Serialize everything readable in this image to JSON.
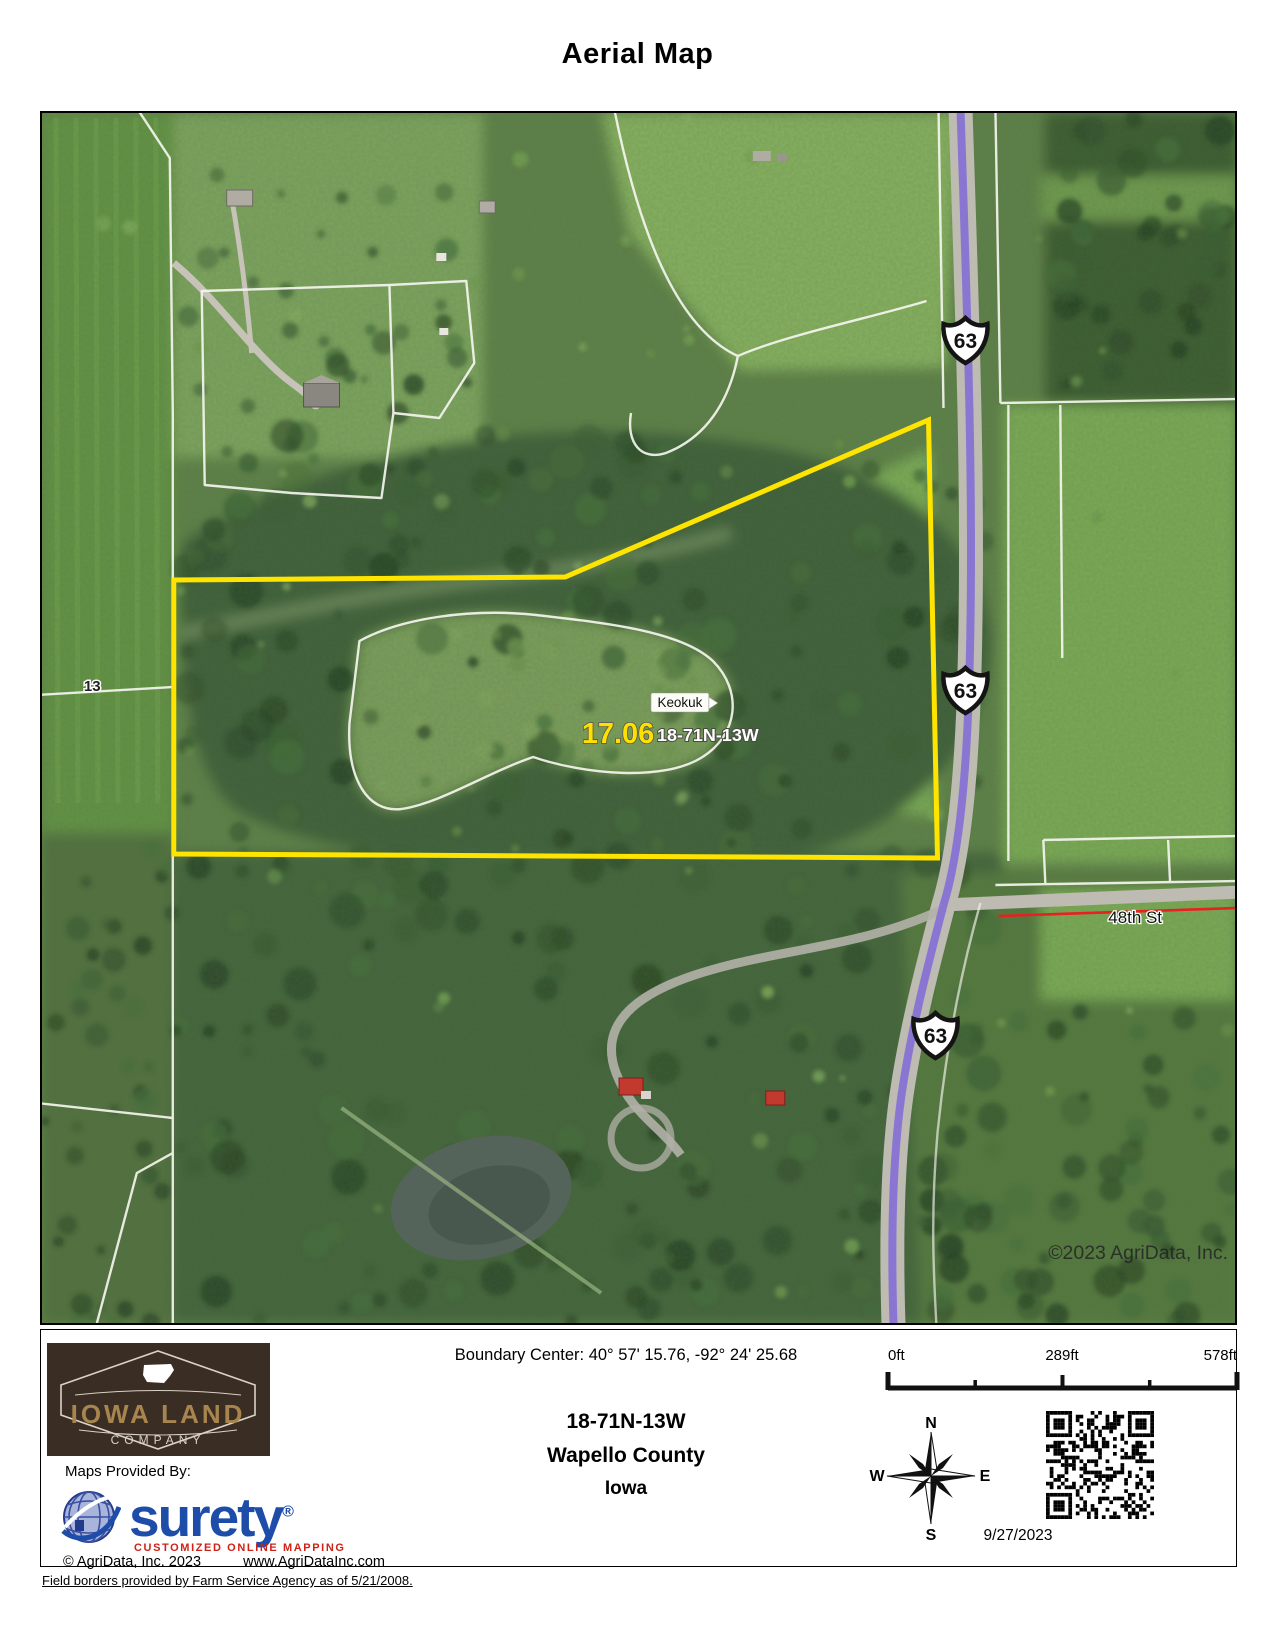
{
  "title": "Aerial Map",
  "map": {
    "acres": "17.06",
    "trs_label": "18-71N-13W",
    "town_label": "Keokuk",
    "section_label": "13",
    "street_label": "48th St",
    "highway_shield": "63",
    "watermark": "©2023 AgriData, Inc.",
    "colors": {
      "parcel_boundary": "#ffe400",
      "highway_overlay": "#8a76d2",
      "street_line": "#e82020",
      "field_boundary": "#f5f5ee"
    }
  },
  "footer": {
    "boundary_center": "Boundary Center: 40° 57' 15.76,  -92° 24' 25.68",
    "trs": "18-71N-13W",
    "county": "Wapello County",
    "state": "Iowa",
    "date": "9/27/2023",
    "scale_labels": [
      "0ft",
      "289ft",
      "578ft"
    ],
    "compass": {
      "n": "N",
      "e": "E",
      "s": "S",
      "w": "W"
    },
    "logo": {
      "line1": "IOWA LAND",
      "line2": "COMPANY"
    },
    "provided_by": "Maps Provided By:",
    "surety_name": "surety",
    "surety_reg": "®",
    "surety_tagline": "CUSTOMIZED ONLINE MAPPING",
    "copyright": "© AgriData, Inc. 2023",
    "website": "www.AgriDataInc.com",
    "field_note": "Field borders provided by Farm Service Agency as of 5/21/2008."
  }
}
